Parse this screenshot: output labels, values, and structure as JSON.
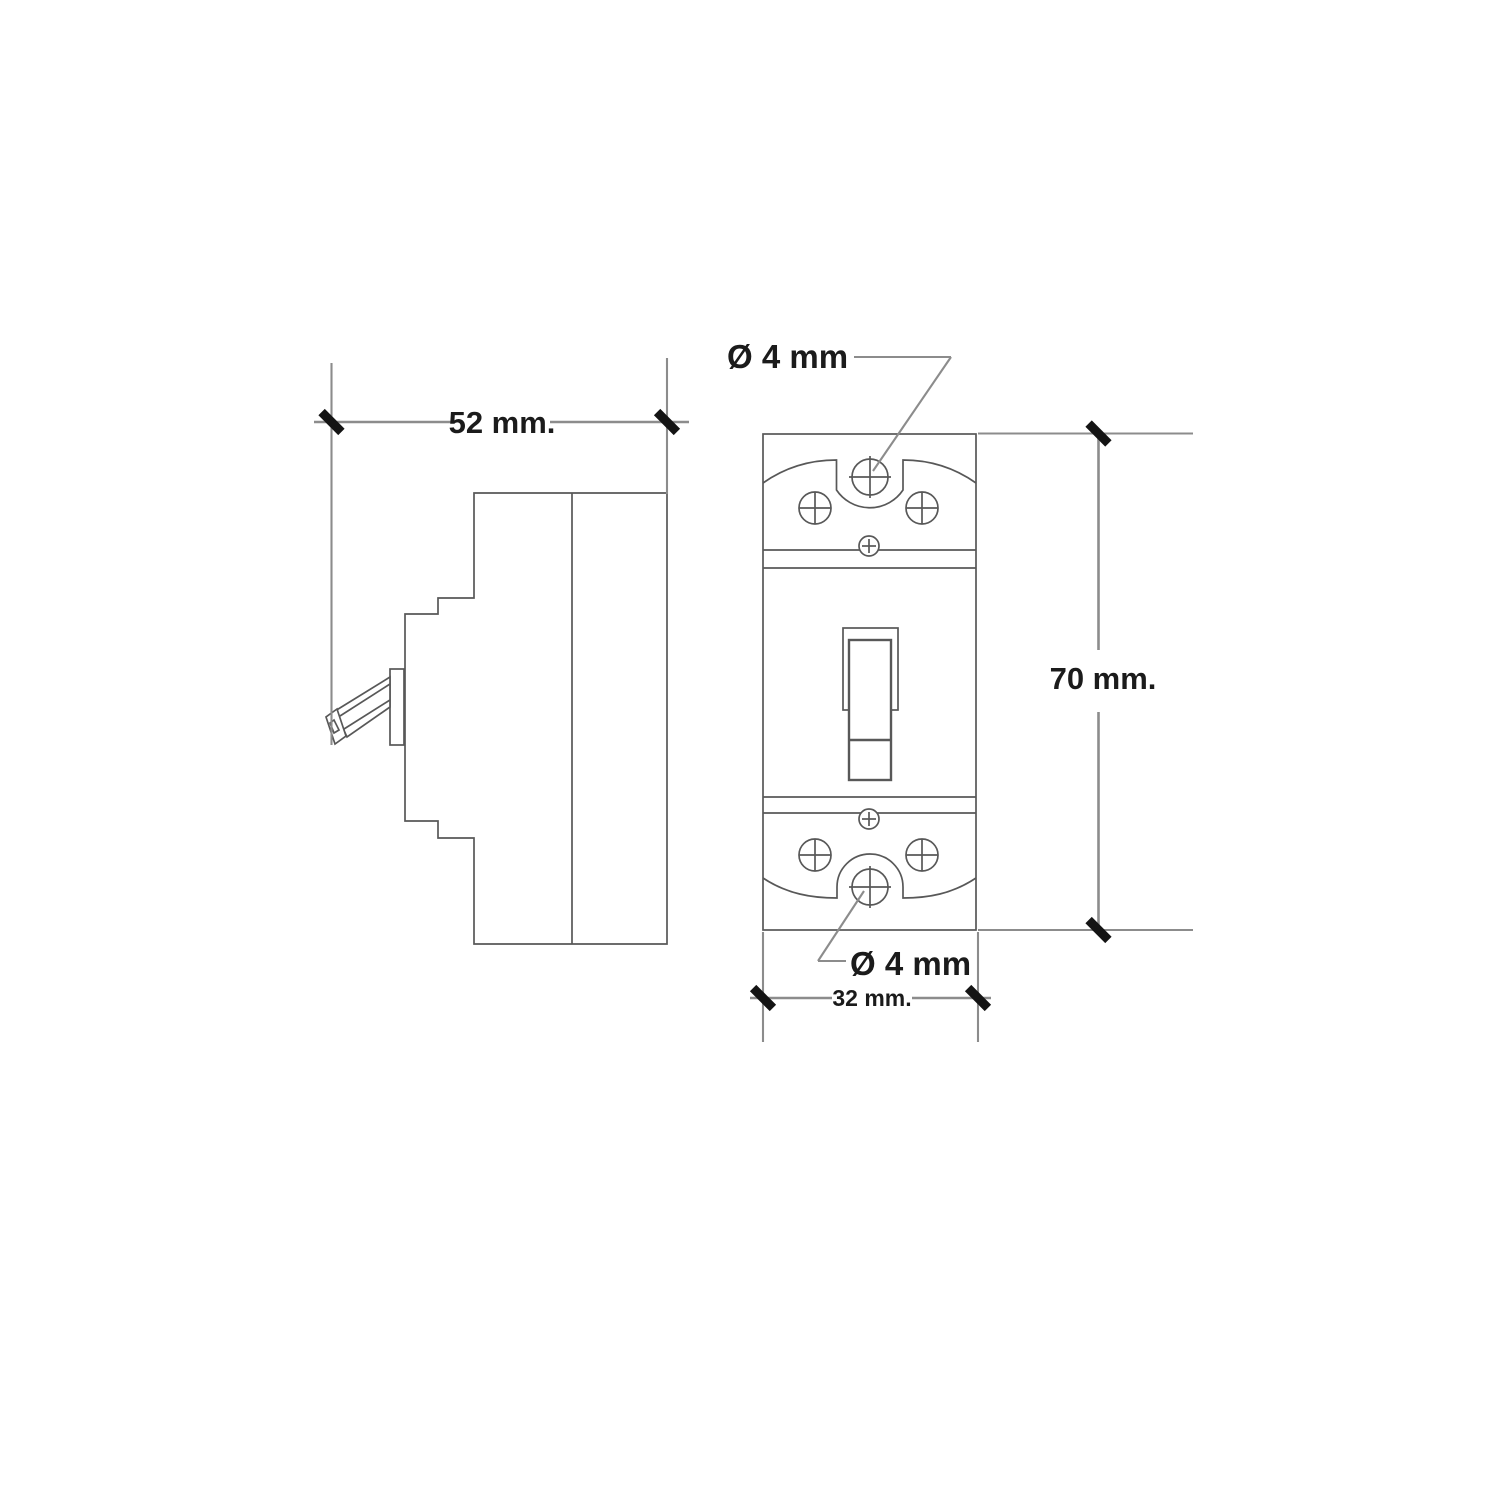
{
  "drawing": {
    "type": "technical-dimension-drawing",
    "subject": "circuit breaker side and front views",
    "labels": {
      "side_depth": "52 mm.",
      "front_height": "70 mm.",
      "front_width": "32 mm.",
      "top_hole_diameter": "Ø 4 mm",
      "bottom_hole_diameter": "Ø 4 mm"
    },
    "colors": {
      "background": "#ffffff",
      "outline": "#585858",
      "dimension": "#8c8c8c",
      "tick": "#141414",
      "text": "#1b1b1b"
    }
  }
}
